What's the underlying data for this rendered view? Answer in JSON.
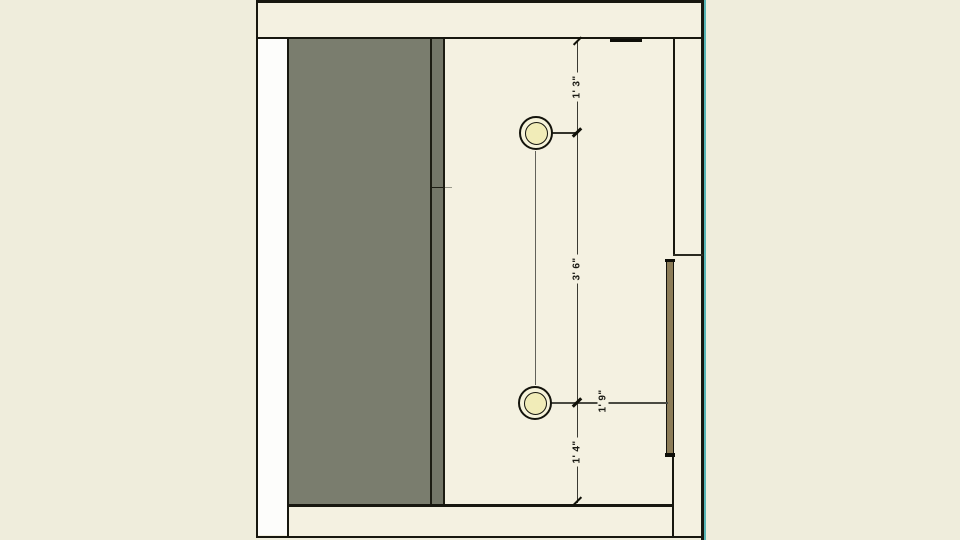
{
  "view": {
    "name": "ceiling-plan-section-view",
    "description": "plan/section drawing with two recessed lights and dimensions"
  },
  "dimensions": {
    "top_offset": {
      "label": "1' 3\""
    },
    "between_lights": {
      "label": "3' 6\""
    },
    "bottom_offset": {
      "label": "1' 4\""
    },
    "side_offset": {
      "label": "1' 9\""
    }
  },
  "fixtures": {
    "light1": {
      "name": "recessed-light"
    },
    "light2": {
      "name": "recessed-light"
    }
  },
  "colors": {
    "outer_background": "#efeddc",
    "interior_fill": "#f4f1e1",
    "cabinet_gray": "#7a7d6e",
    "partition_gray": "#747768",
    "line_black": "#17170f",
    "light_fill": "#f1ecb8",
    "door_leaf_tan": "#8c7c57",
    "section_highlight_teal": "#58b6b6",
    "white_strip": "#fdfdfb"
  }
}
